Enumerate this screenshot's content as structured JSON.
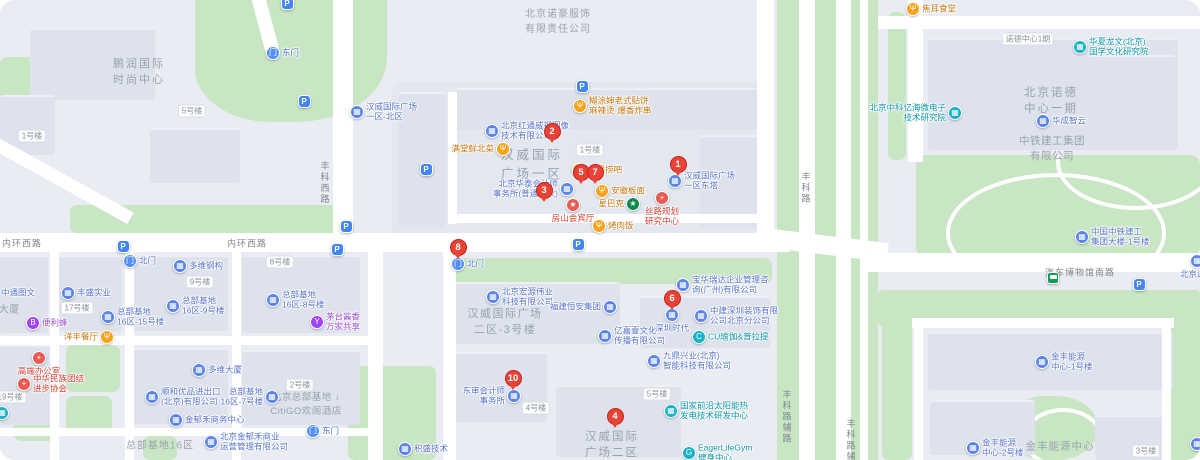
{
  "map_title": "汉威国际广场·总部基地 地图",
  "colors": {
    "marker_red": "#EA4335",
    "marker_border": "#c5221f",
    "company_blue": "#5b84ea",
    "company_text": "#5a74ca",
    "teal": "#17b2c6",
    "teal_text": "#0c96a6",
    "food_orange": "#f5a31a",
    "food_text": "#c5760c",
    "purple": "#a142f4",
    "purple_text": "#9a4fd0",
    "red_poi": "#ea5a52",
    "red_text": "#d23f31",
    "starbucks_green": "#0f8a4f",
    "gate_blue": "#5491f5",
    "gate_text": "#4e74cf",
    "parking_blue": "#4285f4",
    "bus_green": "#0f9d58",
    "road_white": "#ffffff",
    "green_area": "#c9e6c4",
    "area_text": "#9aa2ae"
  },
  "poi_types": {
    "food": {
      "bg": "#f5a31a",
      "glyph": "Ψ",
      "txt": "#c5760c",
      "icon": "restaurant-icon"
    },
    "co": {
      "bg": "#5b84ea",
      "glyph": "▦",
      "txt": "#5a74ca",
      "icon": "company-building-icon"
    },
    "res": {
      "bg": "#17b2c6",
      "glyph": "▦",
      "txt": "#0c96a6",
      "icon": "institute-icon"
    },
    "gym": {
      "bg": "#17b2c6",
      "glyph": "G",
      "txt": "#0c96a6",
      "icon": "gym-icon"
    },
    "yoga": {
      "bg": "#17b2c6",
      "glyph": "C",
      "txt": "#0c96a6",
      "icon": "yoga-icon"
    },
    "bee": {
      "bg": "#a142f4",
      "glyph": "B",
      "txt": "#9a4fd0",
      "icon": "convenience-store-icon"
    },
    "wine": {
      "bg": "#a142f4",
      "glyph": "Y",
      "txt": "#9a4fd0",
      "icon": "liquor-icon"
    },
    "red": {
      "bg": "#ea5a52",
      "glyph": "+",
      "txt": "#d23f31",
      "icon": "red-cross-icon"
    },
    "star": {
      "bg": "#ea5a52",
      "glyph": "★",
      "txt": "#d23f31",
      "icon": "star-icon"
    },
    "sbux": {
      "bg": "#0f8a4f",
      "glyph": "★",
      "txt": "#c5760c",
      "icon": "starbucks-icon"
    },
    "gate": {
      "bg": "#5491f5",
      "glyph": "门",
      "txt": "#4e74cf",
      "icon": "gate-icon"
    }
  },
  "markers": [
    {
      "n": "1",
      "x": 678,
      "y": 166
    },
    {
      "n": "2",
      "x": 552,
      "y": 133
    },
    {
      "n": "3",
      "x": 544,
      "y": 192
    },
    {
      "n": "4",
      "x": 615,
      "y": 418
    },
    {
      "n": "5",
      "x": 581,
      "y": 174
    },
    {
      "n": "6",
      "x": 672,
      "y": 300
    },
    {
      "n": "7",
      "x": 595,
      "y": 174
    },
    {
      "n": "8",
      "x": 458,
      "y": 249
    },
    {
      "n": "10",
      "x": 513,
      "y": 380
    }
  ],
  "pois": [
    {
      "id": "hutushen-restaurant",
      "t": "food",
      "x": 580,
      "y": 106,
      "lp": "r",
      "l": [
        "糊涂婶老式贴饼",
        "麻辣烫·爆香炸串"
      ]
    },
    {
      "id": "hongtong-weishi",
      "t": "co",
      "x": 492,
      "y": 131,
      "lp": "r",
      "l": [
        "北京红通威视图像",
        "技术有限公司"
      ]
    },
    {
      "id": "mantangxian-restaurant",
      "t": "food",
      "x": 503,
      "y": 149,
      "lp": "l",
      "l": [
        "满堂鲜北菜"
      ]
    },
    {
      "id": "hanwei-plaza-north",
      "t": "co",
      "x": 357,
      "y": 112,
      "lp": "r",
      "l": [
        "汉威国际广场",
        "一区-北区"
      ]
    },
    {
      "id": "shuiguolao-bar",
      "t": "food",
      "x": 579,
      "y": 170,
      "lp": "r",
      "l": [
        "水果捞吧"
      ]
    },
    {
      "id": "huatai-accounting",
      "t": "co",
      "x": 567,
      "y": 189,
      "lp": "l",
      "l": [
        "北京华泰会计师",
        "事务所(普通合伙)"
      ]
    },
    {
      "id": "anhui-banmian",
      "t": "food",
      "x": 602,
      "y": 191,
      "lp": "r",
      "l": [
        "安徽板面"
      ]
    },
    {
      "id": "fangshan-hall",
      "t": "star",
      "x": 573,
      "y": 205,
      "lp": "b",
      "l": [
        "房山会宾厅"
      ]
    },
    {
      "id": "starbucks",
      "t": "sbux",
      "x": 633,
      "y": 204,
      "lp": "l",
      "l": [
        "星巴克"
      ]
    },
    {
      "id": "silu-planning-center",
      "t": "red",
      "x": 662,
      "y": 198,
      "lp": "b",
      "l": [
        "丝路规划",
        "研究中心"
      ]
    },
    {
      "id": "kaoroufan",
      "t": "food",
      "x": 599,
      "y": 226,
      "lp": "r",
      "l": [
        "烤肉饭"
      ]
    },
    {
      "id": "hanwei-east-tower",
      "t": "co",
      "x": 675,
      "y": 181,
      "lp": "r",
      "l": [
        "汉威国际广场",
        "一区东塔"
      ]
    },
    {
      "id": "gate-north-center",
      "t": "gate",
      "x": 458,
      "y": 264,
      "lp": "r",
      "l": [
        "北门"
      ]
    },
    {
      "id": "gate-east-top",
      "t": "gate",
      "x": 273,
      "y": 53,
      "lp": "r",
      "l": [
        "东门"
      ]
    },
    {
      "id": "gate-north-left",
      "t": "gate",
      "x": 130,
      "y": 261,
      "lp": "r",
      "l": [
        "北门"
      ]
    },
    {
      "id": "gate-east-bottom",
      "t": "gate",
      "x": 313,
      "y": 431,
      "lp": "r",
      "l": [
        "东门"
      ]
    },
    {
      "id": "duowei-steel",
      "t": "co",
      "x": 180,
      "y": 266,
      "lp": "r",
      "l": [
        "多维钢构"
      ]
    },
    {
      "id": "hongyuan-tech",
      "t": "co",
      "x": 493,
      "y": 297,
      "lp": "r",
      "l": [
        "北京宏源伟业",
        "科技有限公司"
      ]
    },
    {
      "id": "hengan-group",
      "t": "co",
      "x": 610,
      "y": 307,
      "lp": "l",
      "l": [
        "福建恒安集团"
      ]
    },
    {
      "id": "yijiayi-culture",
      "t": "co",
      "x": 605,
      "y": 336,
      "lp": "r",
      "l": [
        "亿嘉壹文化",
        "传播有限公司"
      ]
    },
    {
      "id": "baohua-ruida",
      "t": "co",
      "x": 683,
      "y": 285,
      "lp": "r",
      "l": [
        "宝华瑞达企业管理咨",
        "询(广州)有限公司"
      ]
    },
    {
      "id": "shenzhen-shidai",
      "t": "co",
      "x": 672,
      "y": 315,
      "lp": "b",
      "l": [
        "深圳时代"
      ]
    },
    {
      "id": "zhongjian-decor",
      "t": "co",
      "x": 701,
      "y": 316,
      "lp": "r",
      "l": [
        "中建深圳装饰有限",
        "公司北京分公司"
      ]
    },
    {
      "id": "cu-yoga-pilates",
      "t": "yoga",
      "x": 699,
      "y": 337,
      "lp": "r",
      "l": [
        "CU瑜伽&普拉提"
      ]
    },
    {
      "id": "jiuding-xingye",
      "t": "co",
      "x": 654,
      "y": 361,
      "lp": "r",
      "l": [
        "九鼎兴业(北京)",
        "智能科技有限公司"
      ]
    },
    {
      "id": "solar-rd-center",
      "t": "res",
      "x": 671,
      "y": 411,
      "lp": "r",
      "l": [
        "国家前沿太阳能热",
        "发电技术研发中心"
      ]
    },
    {
      "id": "eager-life-gym",
      "t": "gym",
      "x": 689,
      "y": 453,
      "lp": "r",
      "l": [
        "EagerLifeGym",
        "健身中心"
      ]
    },
    {
      "id": "dongshen-accounting",
      "t": "co",
      "x": 514,
      "y": 396,
      "lp": "l",
      "l": [
        "东审会计师",
        "事务所"
      ]
    },
    {
      "id": "jisheng-tech",
      "t": "co",
      "x": 405,
      "y": 449,
      "lp": "r",
      "l": [
        "积盛技术"
      ]
    },
    {
      "id": "zhongtong-print",
      "t": "co",
      "x": -8,
      "y": 293,
      "lp": "r",
      "l": [
        "中通图文"
      ]
    },
    {
      "id": "fengsheng-industry",
      "t": "co",
      "x": 68,
      "y": 293,
      "lp": "r",
      "l": [
        "丰盛实业"
      ]
    },
    {
      "id": "bianlifeng",
      "t": "bee",
      "x": 33,
      "y": 323,
      "lp": "r",
      "l": [
        "便利蜂"
      ]
    },
    {
      "id": "yangfeng-restaurant",
      "t": "food",
      "x": 107,
      "y": 337,
      "lp": "l",
      "l": [
        "洋丰餐厅"
      ]
    },
    {
      "id": "zbjd-16-15",
      "t": "co",
      "x": 108,
      "y": 317,
      "lp": "r",
      "l": [
        "总部基地",
        "16区-15号楼"
      ]
    },
    {
      "id": "zbjd-16-9",
      "t": "co",
      "x": 173,
      "y": 306,
      "lp": "r",
      "l": [
        "总部基地",
        "16区-9号楼"
      ]
    },
    {
      "id": "zbjd-16-8",
      "t": "co",
      "x": 273,
      "y": 300,
      "lp": "r",
      "l": [
        "总部基地",
        "16区-8号楼"
      ]
    },
    {
      "id": "maotai-share",
      "t": "wine",
      "x": 317,
      "y": 322,
      "lp": "r",
      "l": [
        "茅台酱香",
        "万家共享"
      ]
    },
    {
      "id": "gaoduan-office",
      "t": "red",
      "x": 39,
      "y": 358,
      "lp": "b",
      "l": [
        "高端办公室"
      ]
    },
    {
      "id": "minzu-association",
      "t": "red",
      "x": 24,
      "y": 384,
      "lp": "r",
      "l": [
        "中华民族团结",
        "进步协会"
      ]
    },
    {
      "id": "duowei-tower",
      "t": "co",
      "x": 199,
      "y": 370,
      "lp": "r",
      "l": [
        "多维大厦"
      ]
    },
    {
      "id": "shunhe-import",
      "t": "co",
      "x": 152,
      "y": 397,
      "lp": "r",
      "l": [
        "顺和优品进出口",
        "(北京)有限公司"
      ]
    },
    {
      "id": "jinyuhe-business-center",
      "t": "co",
      "x": 176,
      "y": 420,
      "lp": "r",
      "l": [
        "金郁禾商务中心"
      ]
    },
    {
      "id": "zbjd-16-7",
      "t": "co",
      "x": 272,
      "y": 397,
      "lp": "l",
      "l": [
        "总部基地",
        "16区-7号楼"
      ]
    },
    {
      "id": "jinyuhe-management",
      "t": "co",
      "x": 211,
      "y": 442,
      "lp": "r",
      "l": [
        "北京金郁禾商业",
        "运营管理有限公司"
      ]
    },
    {
      "id": "jiaoer-canteen",
      "t": "food",
      "x": 913,
      "y": 9,
      "lp": "r",
      "l": [
        "焦耳食堂"
      ]
    },
    {
      "id": "huaxia-longwen",
      "t": "res",
      "x": 1080,
      "y": 47,
      "lp": "r",
      "l": [
        "华夏龙文(北京)",
        "国学文化研究院"
      ]
    },
    {
      "id": "zhongke-yihai",
      "t": "res",
      "x": 955,
      "y": 113,
      "lp": "l",
      "l": [
        "北京中科亿海微电子",
        "技术研究院"
      ]
    },
    {
      "id": "huacheng-zhiyun",
      "t": "co",
      "x": 1043,
      "y": 121,
      "lp": "r",
      "l": [
        "华成智云"
      ]
    },
    {
      "id": "zhongtie-tower",
      "t": "co",
      "x": 1082,
      "y": 237,
      "lp": "r",
      "l": [
        "中国中铁建工",
        "集团大楼-1号楼"
      ]
    },
    {
      "id": "nuode-partial",
      "t": "co",
      "x": 1197,
      "y": 261,
      "lp": "b",
      "l": [
        "北京诺德"
      ]
    },
    {
      "id": "jinfeng-energy-1",
      "t": "co",
      "x": 1042,
      "y": 362,
      "lp": "r",
      "l": [
        "金丰能源",
        "中心-1号楼"
      ]
    },
    {
      "id": "jinfeng-energy-2",
      "t": "co",
      "x": 973,
      "y": 448,
      "lp": "r",
      "l": [
        "金丰能源",
        "中心-2号楼"
      ]
    },
    {
      "id": "partial-teal-poi",
      "t": "res",
      "x": 2,
      "y": 413,
      "lp": "r",
      "l": []
    },
    {
      "id": "partial-blue-poi",
      "t": "co",
      "x": 1197,
      "y": 444,
      "lp": "r",
      "l": []
    }
  ],
  "parking_pins": [
    {
      "x": 582,
      "y": 86
    },
    {
      "x": 426,
      "y": 169
    },
    {
      "x": 346,
      "y": 226
    },
    {
      "x": 578,
      "y": 244
    },
    {
      "x": 123,
      "y": 246
    },
    {
      "x": 337,
      "y": 249
    },
    {
      "x": 304,
      "y": 101
    },
    {
      "x": 1139,
      "y": 284
    },
    {
      "x": 287,
      "y": 3
    }
  ],
  "parking_glyph": "P",
  "bus_stop": {
    "x": 1053,
    "y": 278
  },
  "area_labels": [
    {
      "x": 139,
      "y": 71,
      "fs": 11,
      "ls": 2,
      "l": [
        "鹏润国际",
        "时尚中心"
      ]
    },
    {
      "x": 558,
      "y": 20,
      "fs": 10,
      "ls": 1,
      "l": [
        "北京诺豪服饰",
        "有限责任公司"
      ]
    },
    {
      "x": 532,
      "y": 163,
      "fs": 12.5,
      "ls": 3,
      "l": [
        "汉威国际",
        "广场一区"
      ]
    },
    {
      "x": 505,
      "y": 321,
      "fs": 11,
      "ls": 1.5,
      "l": [
        "汉威国际广场",
        "二区-3号楼"
      ]
    },
    {
      "x": 612,
      "y": 444,
      "fs": 11.5,
      "ls": 2,
      "l": [
        "汉威国际",
        "广场二区"
      ]
    },
    {
      "x": 1051,
      "y": 100,
      "fs": 11.5,
      "ls": 2,
      "l": [
        "北京诺德",
        "中心一期"
      ]
    },
    {
      "x": 1052,
      "y": 148,
      "fs": 10.5,
      "ls": 0.5,
      "l": [
        "中铁建工集团",
        "有限公司"
      ]
    },
    {
      "x": 1060,
      "y": 446,
      "fs": 10.5,
      "ls": 1,
      "l": [
        "金丰能源中心"
      ]
    },
    {
      "x": 160,
      "y": 444,
      "fs": 10,
      "ls": 1,
      "l": [
        "总部基地16区"
      ]
    },
    {
      "x": 4,
      "y": 308,
      "fs": 10,
      "ls": 0.5,
      "l": [
        "恒大厦"
      ]
    },
    {
      "x": 306,
      "y": 403,
      "fs": 9.5,
      "ls": 0.5,
      "l": [
        "北京总部基地 ↓",
        "CitiGO欢阁酒店"
      ]
    }
  ],
  "road_labels": [
    {
      "x": 22,
      "y": 243,
      "v": false,
      "label": "内环西路"
    },
    {
      "x": 247,
      "y": 243,
      "v": false,
      "label": "内环西路"
    },
    {
      "x": 325,
      "y": 183,
      "v": true,
      "label": "丰科西路"
    },
    {
      "x": 806,
      "y": 188,
      "v": true,
      "label": "丰科路"
    },
    {
      "x": 787,
      "y": 417,
      "v": true,
      "label": "丰科路辅路"
    },
    {
      "x": 851,
      "y": 446,
      "v": true,
      "label": "丰科路辅路"
    },
    {
      "x": 1080,
      "y": 272,
      "v": false,
      "label": "汽车博物馆南路"
    }
  ],
  "building_tags": [
    {
      "x": 590,
      "y": 150,
      "label": "1号楼"
    },
    {
      "x": 32,
      "y": 136,
      "label": "1号楼"
    },
    {
      "x": 192,
      "y": 111,
      "label": "5号楼"
    },
    {
      "x": 657,
      "y": 394,
      "label": "5号楼"
    },
    {
      "x": 536,
      "y": 408,
      "label": "4号楼"
    },
    {
      "x": 280,
      "y": 262,
      "label": "8号楼"
    },
    {
      "x": 200,
      "y": 282,
      "label": "9号楼"
    },
    {
      "x": 77,
      "y": 308,
      "label": "17号楼"
    },
    {
      "x": 10,
      "y": 397,
      "label": "19号楼"
    },
    {
      "x": 300,
      "y": 385,
      "label": "2号楼"
    },
    {
      "x": 1146,
      "y": 451,
      "label": "3号楼"
    },
    {
      "x": 1028,
      "y": 39,
      "label": "诺德中心1期"
    }
  ]
}
